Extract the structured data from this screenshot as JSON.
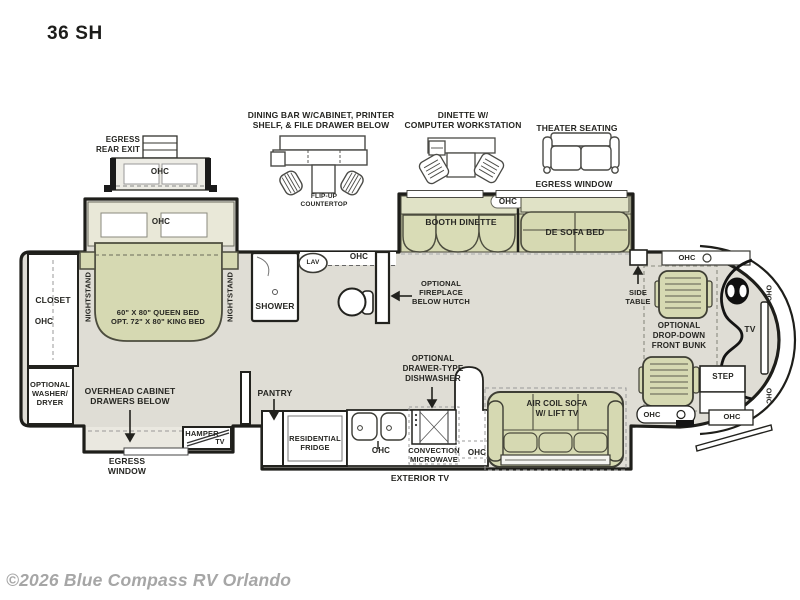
{
  "title": "36 SH",
  "footer": "©2026 Blue Compass RV Orlando",
  "colors": {
    "floor": "#dfddd5",
    "furniture_green": "#d6d9b2",
    "light_green": "#e0e2c6",
    "slide_gray": "#eae8e0",
    "wall": "#1e1e1a",
    "label": "#262622",
    "footer_gray": "#a6a6a6"
  },
  "rear": {
    "egress_exit": "EGRESS\nREAR EXIT",
    "ohc": "OHC"
  },
  "options": {
    "dining_bar": "DINING BAR W/CABINET, PRINTER\nSHELF, & FILE DRAWER BELOW",
    "flip_up": "FLIP-UP\nCOUNTERTOP",
    "dinette": "DINETTE W/\nCOMPUTER WORKSTATION",
    "theater": "THEATER SEATING",
    "egress_window": "EGRESS WINDOW"
  },
  "bedroom": {
    "ohc": "OHC",
    "nightstand": "NIGHTSTAND",
    "bed": "60\" X 80\" QUEEN BED\nOPT. 72\" X 80\" KING BED",
    "closet": "CLOSET",
    "closet_ohc": "OHC",
    "washer": "OPTIONAL\nWASHER/\nDRYER",
    "overhead": "OVERHEAD CABINET\nDRAWERS BELOW",
    "hamper": "HAMPER",
    "tv": "TV",
    "egress_window": "EGRESS\nWINDOW"
  },
  "bath": {
    "shower": "SHOWER",
    "lav": "LAV",
    "ohc": "OHC",
    "fireplace": "OPTIONAL\nFIREPLACE\nBELOW HUTCH"
  },
  "living": {
    "booth": "BOOTH DINETTE",
    "ohc": "OHC",
    "sofa_bed": "DE SOFA BED",
    "side_table": "SIDE\nTABLE",
    "sofa": "AIR COIL SOFA\nW/ LIFT TV"
  },
  "kitchen": {
    "pantry": "PANTRY",
    "fridge": "RESIDENTIAL\nFRIDGE",
    "ohc_left": "OHC",
    "dishwasher": "OPTIONAL\nDRAWER-TYPE\nDISHWASHER",
    "microwave": "CONVECTION\nMICROWAVE",
    "ohc_right": "OHC",
    "exterior_tv": "EXTERIOR TV"
  },
  "front": {
    "ohc_top": "OHC",
    "bunk": "OPTIONAL\nDROP-DOWN\nFRONT BUNK",
    "tv": "TV",
    "ohc_cap_top": "OHC",
    "ohc_cap_bottom": "OHC",
    "step": "STEP",
    "ohc_entry": "OHC",
    "ohc_step": "OHC"
  }
}
